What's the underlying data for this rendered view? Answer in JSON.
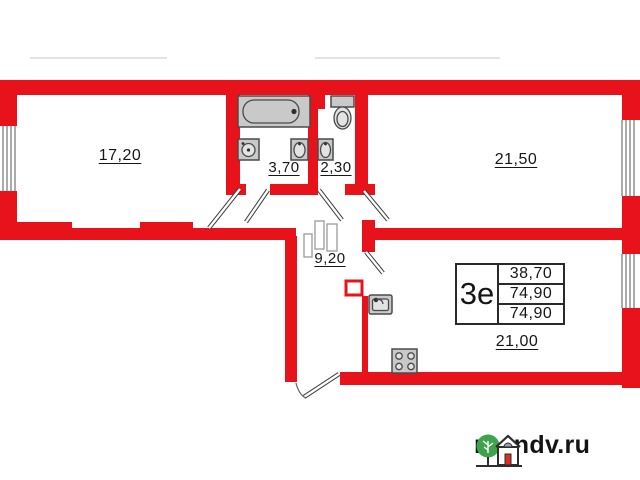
{
  "plan": {
    "rooms": {
      "room1": {
        "name": "living-room-1",
        "area": "17,20"
      },
      "bathroom": {
        "name": "bathroom",
        "area": "3,70"
      },
      "toilet": {
        "name": "toilet",
        "area": "2,30"
      },
      "room2": {
        "name": "living-room-2",
        "area": "21,50"
      },
      "hallway": {
        "name": "hallway",
        "area": "9,20"
      },
      "kitchen": {
        "name": "kitchen-living",
        "area": "21,00"
      }
    },
    "info_table": {
      "type_label": "3е",
      "rows": [
        "38,70",
        "74,90",
        "74,90"
      ]
    },
    "fixtures": [
      "bathtub",
      "washing-machine",
      "bath-sink",
      "toilet-sink",
      "toilet",
      "wardrobe",
      "vent-shaft",
      "kitchen-sink",
      "stove"
    ],
    "colors": {
      "wall": "#e8131a",
      "fixture_fill": "#c9c9c9",
      "text": "#161616"
    }
  },
  "watermark": {
    "text": "rosndv.ru",
    "tree_color": "#3fa34d",
    "door_color": "#d93025",
    "window_color": "#8fa6bd"
  }
}
